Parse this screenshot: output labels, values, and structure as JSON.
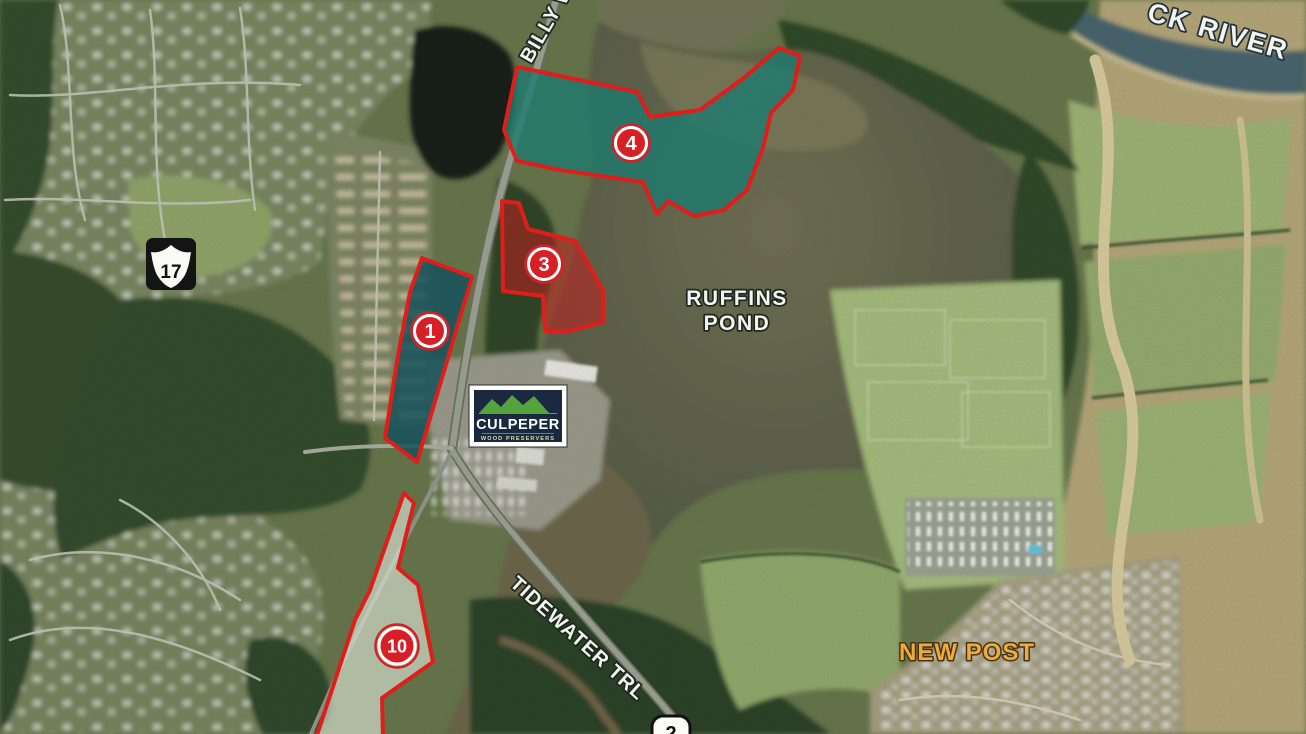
{
  "labels": {
    "pond_line1": "RUFFINS",
    "pond_line2": "POND",
    "river": "CK RIVER",
    "road_billy": "BILLY W",
    "road_tidewater": "TIDEWATER TRL",
    "place_new_post": "NEW POST"
  },
  "markers": [
    {
      "number": "1"
    },
    {
      "number": "3"
    },
    {
      "number": "4"
    },
    {
      "number": "10"
    }
  ],
  "shields": {
    "us17": "17",
    "va2": "2"
  },
  "logo": {
    "title": "CULPEPER",
    "subtitle": "WOOD PRESERVERS"
  },
  "colors": {
    "parcel_outline": "#df1e1c",
    "teal_fill": "#1e7b6f",
    "teal_fill_dark": "#15525a",
    "red_fill": "#bf1f1f",
    "light_fill": "#e3ecdd",
    "marker_red": "#d81f26",
    "new_post_text": "#f0a93c"
  }
}
